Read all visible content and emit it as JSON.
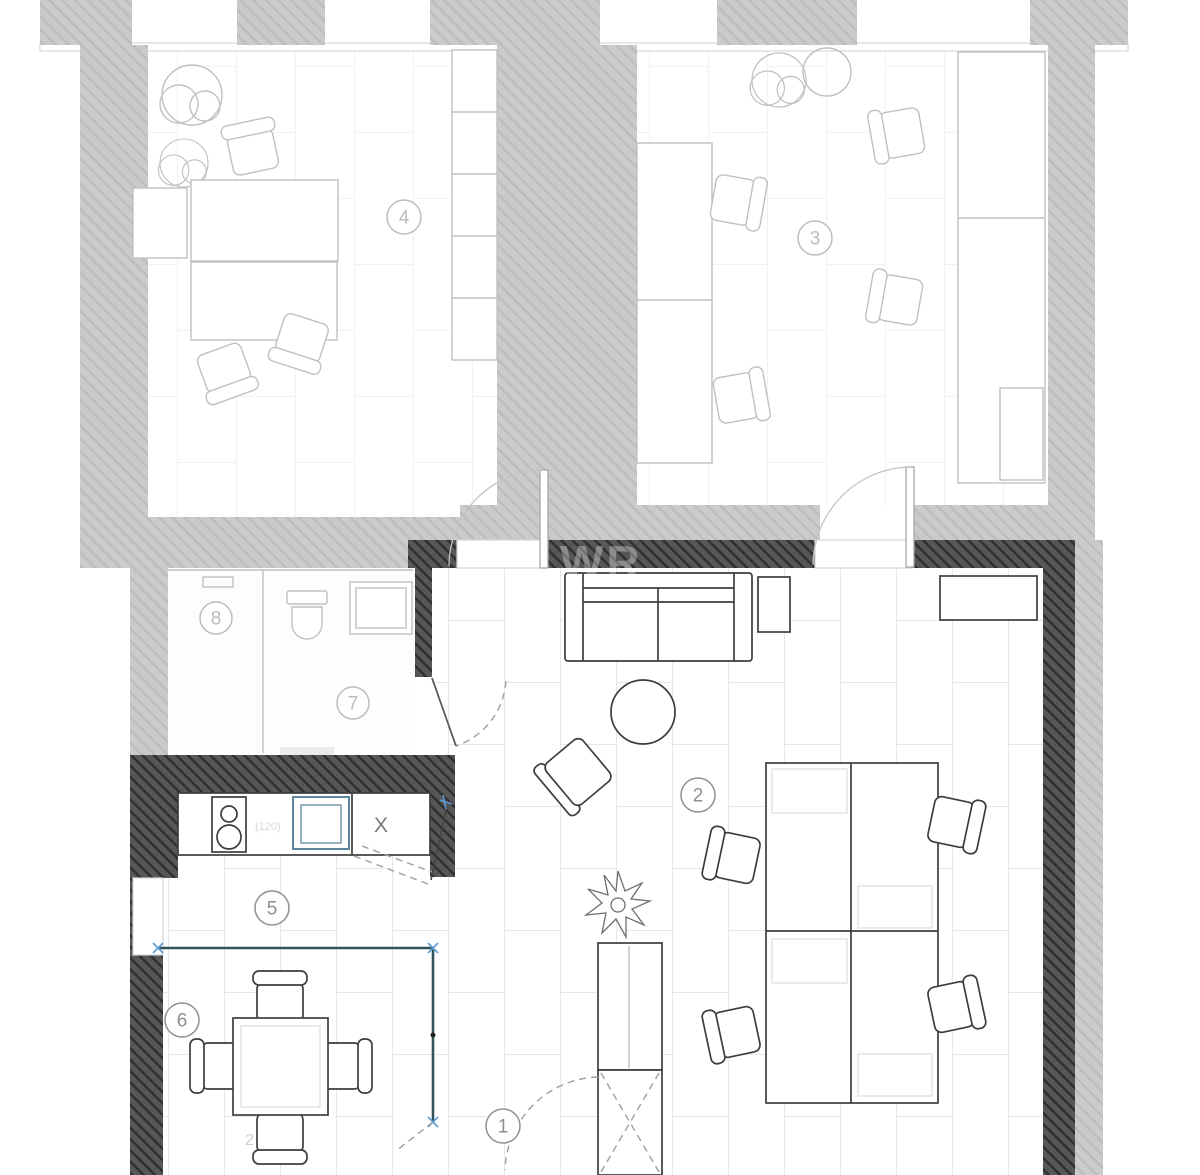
{
  "plan": {
    "type": "floor-plan",
    "rooms": [
      {
        "id": 1,
        "label": "1"
      },
      {
        "id": 2,
        "label": "2"
      },
      {
        "id": 3,
        "label": "3"
      },
      {
        "id": 4,
        "label": "4"
      },
      {
        "id": 5,
        "label": "5"
      },
      {
        "id": 6,
        "label": "6"
      },
      {
        "id": 7,
        "label": "7"
      },
      {
        "id": 8,
        "label": "8"
      }
    ],
    "watermark": "WR",
    "annotations": {
      "kitchen_x_mark": "X",
      "stove_dimension": "(120)",
      "pencil_mark": "2"
    },
    "theme": {
      "wall_light": "#cbcbcb",
      "wall_light_line": "#bcbcbc",
      "wall_dark": "#575757",
      "wall_dark_line": "#303030",
      "line_main": "#3d3d3d",
      "line_faded": "#bdc1c4",
      "floor_line_main": "#e7e7e7",
      "floor_line_upper": "#f1f1f1",
      "partition": "#33535a",
      "marker_blue": "#5b9bd5",
      "sink_blue": "#5d87a0",
      "label_main": "#8f8f8f",
      "label_faded": "#bdbdbd"
    }
  }
}
